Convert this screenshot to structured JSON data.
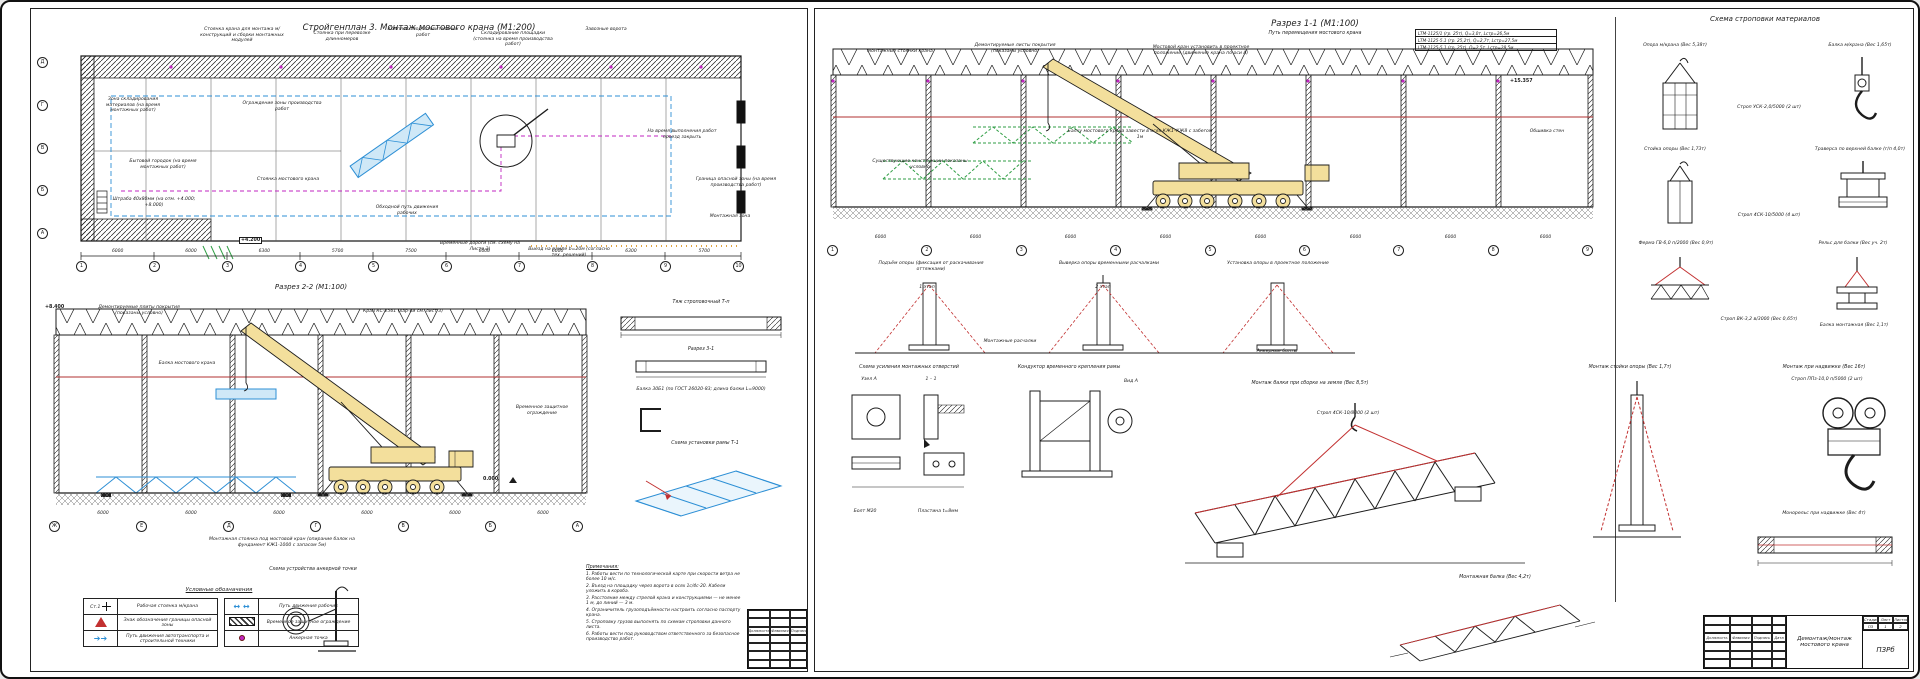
{
  "colors": {
    "line": "#1c1c1c",
    "blue": "#2d8fd5",
    "green": "#2f9e44",
    "magenta": "#c026c0",
    "red": "#c23030",
    "orange": "#e2a23c",
    "yellow": "#f3df9c"
  },
  "left": {
    "title": "Стройгенплан 3. Монтаж мостового крана (М1:200)",
    "plan": {
      "callouts": [
        "Стоянка крана для монтажа м/конструкций и сборки монтажных модулей",
        "Стоянка при перевозке длинномеров",
        "Комплекс подготовительных работ",
        "Складирование площадки (стоянка на время производства работ)",
        "Завозные ворота",
        "Зона складирования материалов (на время монтажных работ)",
        "Бытовой городок (на время монтажных работ)",
        "Ограждение зоны производства работ",
        "Штраба 40х80мм (на отм. +4.000; +8.000)",
        "Обходной путь движения рабочих",
        "Стоянка мостового крана",
        "На время выполнения работ проезд закрыть",
        "Временные дороги (см. схему на Листе 3)",
        "Выезд на рампе b=20м (согласно тех. решений)",
        "Граница опасной зоны (на время производства работ)",
        "Монтажная зона"
      ],
      "elevation": "+4.200",
      "dims": [
        "6000",
        "6000",
        "6300",
        "5700",
        "7500",
        "6000",
        "6000",
        "6300",
        "5700"
      ],
      "grid_cols": [
        "1",
        "2",
        "3",
        "4",
        "5",
        "6",
        "7",
        "8",
        "9",
        "10"
      ],
      "grid_rows": [
        "Д",
        "Г",
        "В",
        "Б",
        "А"
      ]
    },
    "section": {
      "title": "Разрез 2-2 (М1:100)",
      "callouts": [
        "Кран КС-2561 (хар-ки см. лист 3)",
        "Демонтируемые плиты покрытия (показаны условно)",
        "Временное защитное ограждение",
        "Балка мостового крана",
        "Монтажная стоянка под мостовой кран (опирание балок на фундамент КЖ1-1000 с запасом 5м)"
      ],
      "elev_top": "+8.400",
      "elev_zero": "0.000",
      "dims": [
        "6000",
        "6000",
        "6000",
        "6000",
        "6000",
        "6000"
      ],
      "grids": [
        "Ж",
        "Е",
        "Д",
        "Г",
        "В",
        "Б",
        "А"
      ]
    },
    "details": {
      "beam1_title": "Тяж строповочный Т-п",
      "beam2_title": "Разрез 3-1",
      "beam_note": "Балка 30Б1 (по ГОСТ 26020-83; длина балки L=9000)",
      "frame_title": "Схема установки рамы Т-1"
    },
    "anchor_title": "Схема устройства анкерной точки",
    "legend": {
      "title": "Условные обозначения",
      "station_label": "Ст.1",
      "left_rows": [
        "Рабочая стоянка м/крана",
        "Знак обозначения границы опасной зоны",
        "Путь движения автотранспорта и строительной техники"
      ],
      "right_rows": [
        "Путь движения рабочих",
        "Временное защитное ограждение",
        "Анкерная точка"
      ]
    },
    "notes": {
      "title": "Примечания:",
      "items": [
        "1. Работы вести по технологической карте при скорости ветра не более 10 м/с.",
        "2. Въезд на площадку через ворота в осях 1с/4с-20. Кабели уложить в короба.",
        "3. Расстояние между стрелой крана и конструкциями — не менее 1 м, до линий — 3 м.",
        "4. Ограничитель грузоподъёмности настроить согласно паспорту крана.",
        "5. Строповку грузов выполнять по схемам строповки данного листа.",
        "6. Работы вести под руководством ответственного за безопасное производство работ."
      ]
    },
    "title_block": {
      "sig_headers": [
        "Должность",
        "Фамилия",
        "Подпись"
      ]
    }
  },
  "right": {
    "title": "Разрез 1-1 (М1:100)",
    "subtitle": "Путь перемещения мостового крана",
    "crane_specs": [
      "LTM-1125/1 (гр. 25т), Q=3,0т, Lстр=26,5м",
      "LTM-1125-5.1 (гр. 25,2т), Q=2,7т, Lстр=27,5м",
      "LTM-1125-5.1 (гр. 25т), Q=2,5т, Lстр=28,5м"
    ],
    "elevation": "+15.357",
    "section": {
      "callouts": [
        "Монтажные стоянки крана",
        "Демонтируемые листы покрытия (показаны условно)",
        "Мостовой кран установить в проектное положение (движение крана по оси А)",
        "Существующие конструкции показаны условно",
        "Балку мостового крана завести в осях КЖ1–КЖ8 с забегом 1м",
        "Обшивка стен"
      ],
      "dims": [
        "6000",
        "6000",
        "6000",
        "6000",
        "6000",
        "6000",
        "6000",
        "6000"
      ],
      "grids": [
        "1",
        "2",
        "3",
        "4",
        "5",
        "6",
        "7",
        "8",
        "9"
      ]
    },
    "stages": {
      "items": [
        "Подъём опоры (фиксация от раскачивания оттяжками)",
        "Выверка опоры временными расчалками",
        "Установка опоры в проектное положение"
      ],
      "labels": [
        "1 этап",
        "2 этап",
        "Монтажные расчалки",
        "Анкерные болты"
      ]
    },
    "sling": {
      "title": "Схема строповки материалов",
      "items": [
        "Опора м/крана (Вес 5,38т)",
        "Балка м/крана (Вес 1,65т)",
        "Строп УСК-2,0/5000 (2 шт)",
        "Траверса по верхней балке (г/п 4,0т)",
        "Стойка опоры (Вес 1,73т)",
        "Строп 4СК-10/5000 (4 шт)",
        "Ферма ГВ-6,0 п/2000 (Вес 0,9т)",
        "Рельс для балки (Вес уч. 2т)",
        "Строп ВК-3,2 в/3000 (Вес 0,65т)",
        "Балка монтажная (Вес 1,1т)"
      ]
    },
    "details": {
      "holes_title": "Схема усиления монтажных отверстий",
      "node_a": "Узел А",
      "sec_11": "1 – 1",
      "bolt": "Болт М20",
      "plate": "Пластина t=8мм",
      "conductor_title": "Кондуктор временного крепления рамы",
      "vid_a": "Вид А",
      "stand_title": "Монтаж стойки опоры (Вес 1,7т)",
      "truss_title": "Монтаж балки при сборке на земле (Вес 8,5т)",
      "truss_sling": "Строп 4СК-10/8000 (2 шт)",
      "hook_title": "Монтаж при надвижке (Вес 16т)",
      "hook_sling": "Строп ППз-10,0 п/5000 (2 шт)",
      "beam_label": "Монорельс при надвижке (Вес 4т)",
      "small_truss": "Монтажная балка (Вес 4,2т)"
    },
    "title_block": {
      "project": "Демонтаж/монтаж мостового крана",
      "sig_headers": [
        "Должность",
        "Фамилия",
        "Подпись",
        "Дата"
      ],
      "stage_headers": [
        "Стадия",
        "Лист",
        "Листов"
      ],
      "stage_values": [
        "ПЗ",
        "1",
        "2"
      ],
      "code": "ПЗРб"
    }
  }
}
